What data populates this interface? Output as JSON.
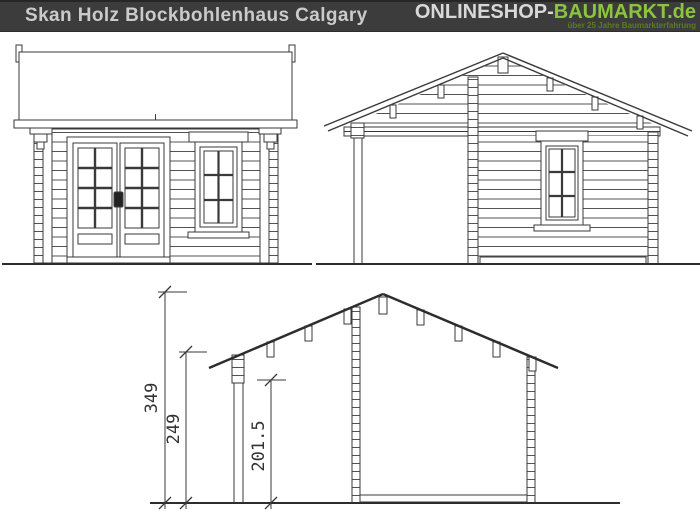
{
  "header": {
    "title": "Skan Holz Blockbohlenhaus Calgary",
    "logo": {
      "part1": "ONLINESHOP-",
      "part2": "BAUMARKT",
      "part3": ".de",
      "tagline": "über 25 Jahre Baumarkterfahrung"
    },
    "colors": {
      "bar_background": "#3c3c3c",
      "title_text": "#cbcbcb",
      "logo_gray": "#d8d8d8",
      "logo_green": "#8bc53f",
      "tagline_green": "#5d7b26"
    }
  },
  "drawings": {
    "ink_color": "#3a3a3a",
    "product": "Blockbohlenhaus Calgary",
    "views": {
      "front_elevation": "front elevation with double glazed door and window",
      "side_elevation": "side elevation with gable roof, porch post and window",
      "section": "cross section with height dimensions"
    },
    "section": {
      "dimensions": [
        {
          "id": "ridge-height",
          "label": "349"
        },
        {
          "id": "eave-height",
          "label": "249"
        },
        {
          "id": "wall-height",
          "label": "201.5"
        }
      ]
    }
  }
}
